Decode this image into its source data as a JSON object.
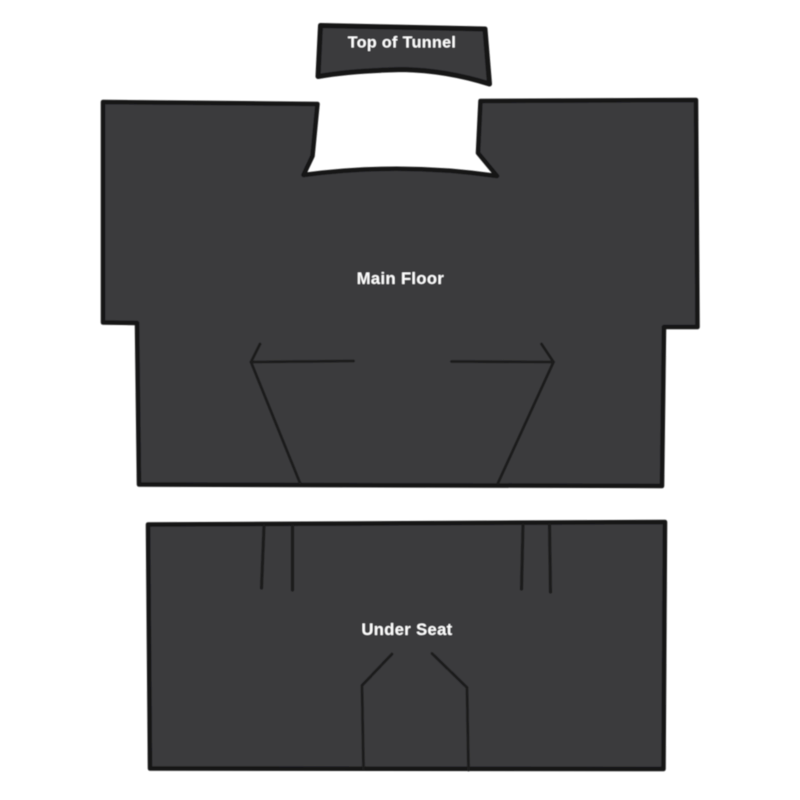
{
  "colors": {
    "background": "#FFFFFF",
    "piece_fill": "#3A3A3C",
    "piece_outline": "#161616",
    "cut_line": "#1C1C1C",
    "label_text": "#FFFFFF"
  },
  "pieces": {
    "tunnel_top": {
      "label": "Top of Tunnel"
    },
    "main_floor": {
      "label": "Main Floor"
    },
    "under_seat": {
      "label": "Under Seat"
    }
  }
}
